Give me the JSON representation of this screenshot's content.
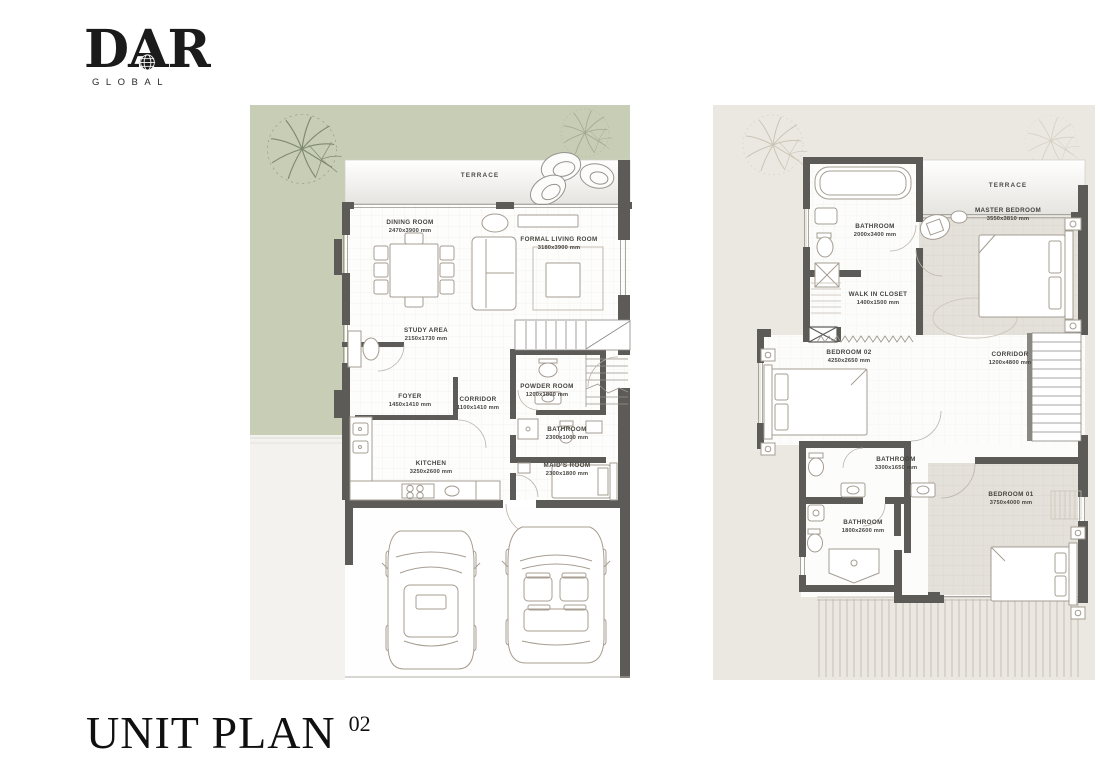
{
  "logo": {
    "brand": "DAR",
    "subtitle": "GLOBAL"
  },
  "title": {
    "label": "UNIT PLAN",
    "number": "02"
  },
  "colors": {
    "page_bg": "#ffffff",
    "landscape_green": "#c8ceb6",
    "plan_cream": "#eae8e1",
    "wall_dark": "#5c5b57",
    "floor_beige": "#e3e0d9",
    "furniture_line": "#a59c92",
    "label_text": "#45443f",
    "logo_ink": "#1b1b1b"
  },
  "ground_floor": {
    "terrace": "TERRACE",
    "rooms": [
      {
        "name": "DINING ROOM",
        "dims": "2470x3900 mm"
      },
      {
        "name": "FORMAL LIVING ROOM",
        "dims": "3180x3900 mm"
      },
      {
        "name": "STUDY AREA",
        "dims": "2150x1730 mm"
      },
      {
        "name": "FOYER",
        "dims": "1450x1410 mm"
      },
      {
        "name": "CORRIDOR",
        "dims": "1100x1410 mm"
      },
      {
        "name": "POWDER ROOM",
        "dims": "1200x1800 mm"
      },
      {
        "name": "BATHROOM",
        "dims": "2300x1000 mm"
      },
      {
        "name": "KITCHEN",
        "dims": "3250x2600 mm"
      },
      {
        "name": "MAID'S ROOM",
        "dims": "2300x1800 mm"
      }
    ]
  },
  "first_floor": {
    "terrace": "TERRACE",
    "rooms": [
      {
        "name": "BATHROOM",
        "dims": "2000x3400 mm"
      },
      {
        "name": "MASTER BEDROOM",
        "dims": "3550x3810 mm"
      },
      {
        "name": "WALK IN CLOSET",
        "dims": "1400x1500 mm"
      },
      {
        "name": "BEDROOM 02",
        "dims": "4250x2650 mm"
      },
      {
        "name": "CORRIDOR",
        "dims": "1200x4800 mm"
      },
      {
        "name": "BATHROOM",
        "dims": "3300x1650 mm"
      },
      {
        "name": "BATHROOM",
        "dims": "1800x2600 mm"
      },
      {
        "name": "BEDROOM 01",
        "dims": "3750x4000 mm"
      }
    ]
  }
}
